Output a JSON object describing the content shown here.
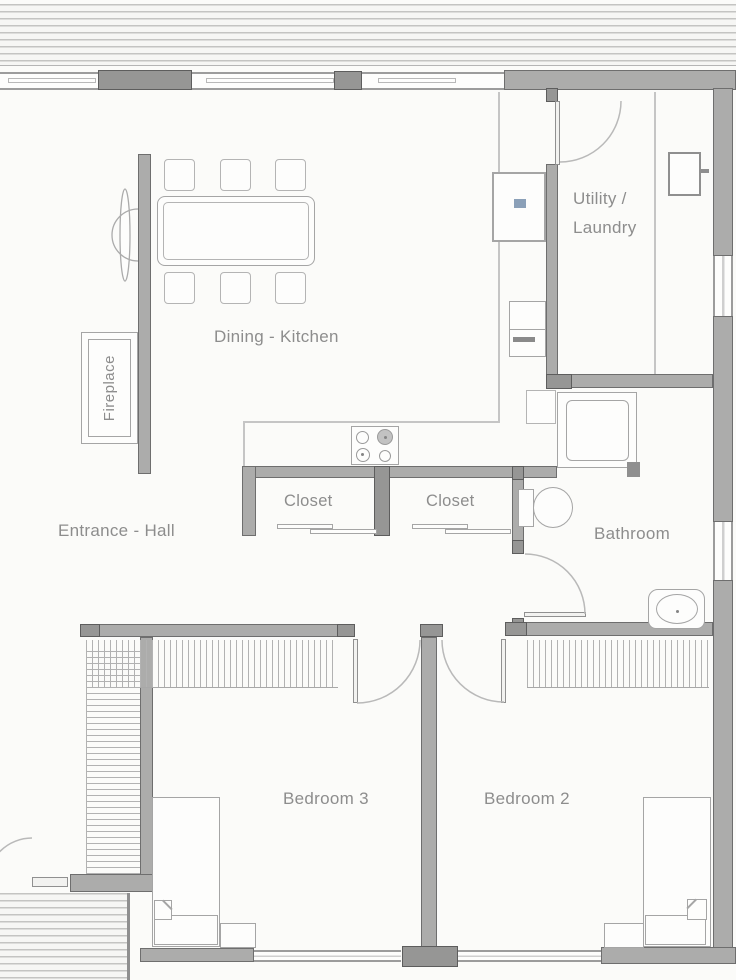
{
  "labels": {
    "utility_line1": "Utility /",
    "utility_line2": "Laundry",
    "dining_kitchen": "Dining - Kitchen",
    "fireplace": "Fireplace",
    "entrance_hall": "Entrance - Hall",
    "closet_left": "Closet",
    "closet_right": "Closet",
    "bathroom": "Bathroom",
    "bedroom3": "Bedroom 3",
    "bedroom2": "Bedroom 2"
  },
  "colors": {
    "wall": "#acacab",
    "wallDark": "#969695",
    "edge": "#6e6e6e",
    "furn": "#a5a5a5",
    "thin": "#c5c5c5",
    "text": "#8d8d8d",
    "stripe": "#c4c4c2",
    "accent": "#8ba0b8",
    "bg": "#fbfbf9",
    "arc": "#b9b9b9"
  }
}
